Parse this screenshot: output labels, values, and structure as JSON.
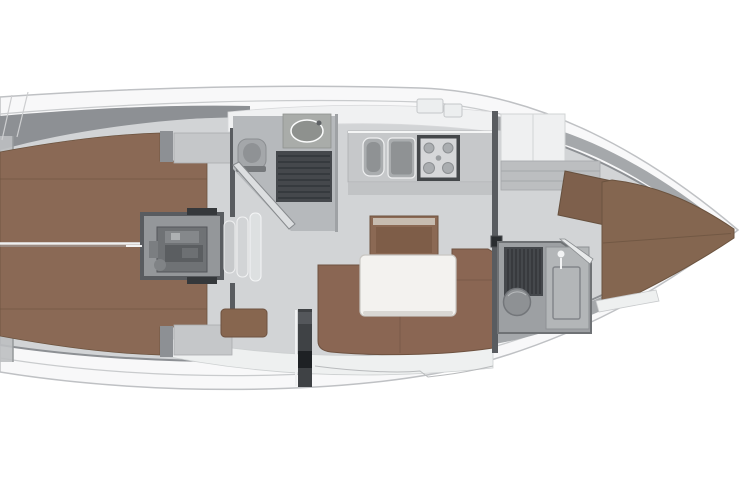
{
  "plan": {
    "type": "sailing-yacht-interior-floor-plan",
    "view": "top-down",
    "orientation": "bow-right-stern-left"
  },
  "areas": [
    "hull",
    "side-deck",
    "aft-cabin-port",
    "aft-cabin-starboard",
    "engine-compartment",
    "companionway-steps",
    "aft-head",
    "galley",
    "saloon",
    "forward-head",
    "forward-cabin",
    "v-berth"
  ],
  "palette": {
    "page_bg": "#ffffff",
    "hull_fill": "#f8f8f9",
    "hull_stroke": "#bfc1c4",
    "deck_line": "#c9cbcd",
    "floor": "#d2d4d6",
    "floor_dark": "#b6b9bc",
    "wall_dark": "#595c60",
    "wall_mid": "#8d9094",
    "wedge_bow": "#a5a8ab",
    "white_band": "#f0f1f2",
    "white_band_bottom": "#eef0f0",
    "stern_band": "#bdbfc1",
    "berth": "#8a6955",
    "berth_fwd": "#846650",
    "seam": "#6b533f",
    "settee": "#8a6653",
    "bench": "#87664f",
    "cabinet": "#8b6954",
    "cabinet_inner": "#7e5d48",
    "cabinet_rim": "#c7bcb0",
    "table": "#f3f2ef",
    "table_shade": "#d9d7d3",
    "counter": "#c6c8ca",
    "counter_front": "#bec0c2",
    "appliance": "#aaadaf",
    "appliance_inner": "#8f9294",
    "stove_frame": "#44474a",
    "stove_top": "#d6d7d9",
    "burner": "#aaadb0",
    "grate": "#45484c",
    "grate_line": "#2f3236",
    "engine_box": "#94979a",
    "engine": "#6f7275",
    "engine_dark": "#5b5e61",
    "engine_light": "#85888b",
    "step1": "#c7c9cb",
    "step2": "#d2d4d6",
    "step3": "#dde0e1",
    "fixture": "#8e9194",
    "shower_panel": "#b3b6b8",
    "toilet": "#a4a7aa",
    "toilet_seat": "#8f9295",
    "basin_counter": "#a9aca9",
    "basin": "#8e918e",
    "post": "#3f4245",
    "post_dark": "#1e2124",
    "locker": "#eff0f1",
    "locker_gray": "#c5c7c9",
    "shelf": "#bcbec0",
    "hatch": "#eceeef",
    "white_trim": "#f2f3f4"
  }
}
